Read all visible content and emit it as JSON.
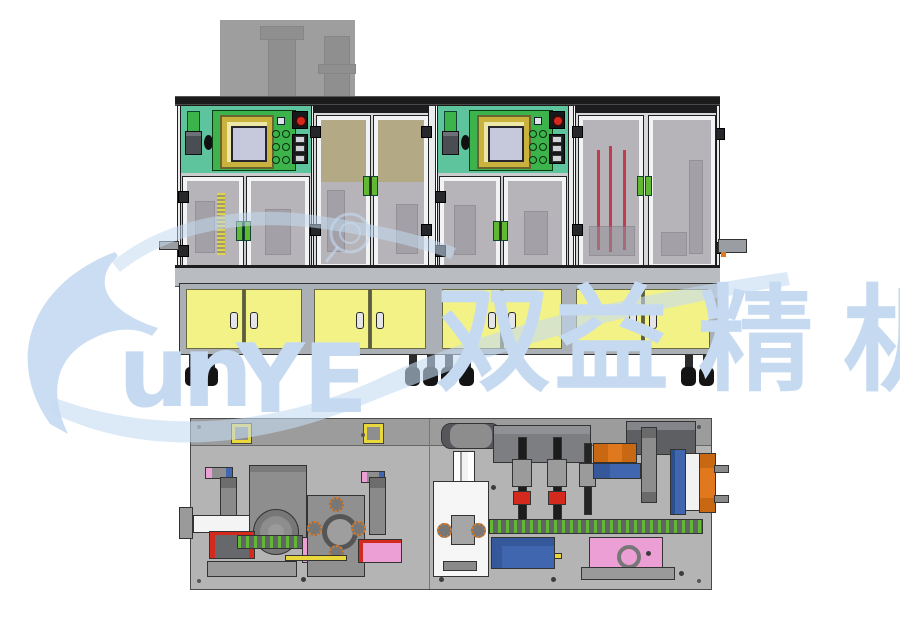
{
  "watermark": {
    "brand_text": "SunYE",
    "letter_u": "u",
    "letter_n": "n",
    "letter_y": "Y",
    "letter_e": "E",
    "cjk_1": "双",
    "cjk_2": "益",
    "cjk_3": "精",
    "cjk_4": "机",
    "cjk_text": "双益精机",
    "color": "#c5daf1"
  },
  "colors": {
    "wm": "#c5daf1",
    "teal": "#5ec49e",
    "green": "#3cb44b",
    "cream": "#ece9a8",
    "gold": "#c9b23e",
    "screen": "#c6c9db",
    "red": "#d42a1e",
    "rodred": "#c23b4e",
    "orange": "#e0781e",
    "blue": "#3f66ae",
    "pink": "#ec9fd4",
    "yellow": "#f2f287",
    "yellow2": "#e8d83c",
    "glass": "#b6b4b8",
    "tan": "#b3a77f",
    "handle": "#62b832",
    "gray1": "#b4b4b4",
    "gray2": "#9c9c9c"
  },
  "front_view": {
    "description": "front elevation of twin-module automated assembly machine",
    "modules": [
      {
        "id": "module-1",
        "control_panel": {
          "screen": "hmi-touchscreen",
          "indicator_lights": 1,
          "push_buttons": 6,
          "emergency_stop": true,
          "signal_tower": true,
          "connector_panel": true
        },
        "doors": {
          "upper_control_bay": 2,
          "upper_door_bay": 2,
          "lower_cabinet": 4
        },
        "door_handle_color": "green",
        "cabinet_color": "yellow",
        "casters": 2
      },
      {
        "id": "module-2",
        "control_panel": {
          "screen": "hmi-touchscreen",
          "indicator_lights": 1,
          "push_buttons": 6,
          "emergency_stop": true,
          "signal_tower": true,
          "connector_panel": true
        },
        "doors": {
          "upper_control_bay": 2,
          "upper_door_bay": 2,
          "lower_cabinet": 4
        },
        "door_handle_color": "green",
        "cabinet_color": "yellow",
        "casters": 2
      }
    ],
    "background_block": "overhead equipment silhouette"
  },
  "plan_view": {
    "description": "top plan of machine base plate with stations",
    "components": [
      "yellow-locator-bracket",
      "yellow-locator-bracket-2",
      "vertical-actuator-pair",
      "gray-gearbox-block",
      "rotary-flange",
      "center-index-plate-with-bolt-circles",
      "white-linear-rail",
      "clamp-unit",
      "pink-fixture-plates",
      "white-cylinder",
      "white-station-plate",
      "dark-housing",
      "vertical-slide-rails",
      "red-grip-pads",
      "orange-block-cluster",
      "blue-block-row",
      "blue-rail",
      "orange-pad-column",
      "green-dot-conveyor-rail",
      "blue-bottom-plate",
      "pink-bottom-plate",
      "corner-drive-unit"
    ]
  }
}
